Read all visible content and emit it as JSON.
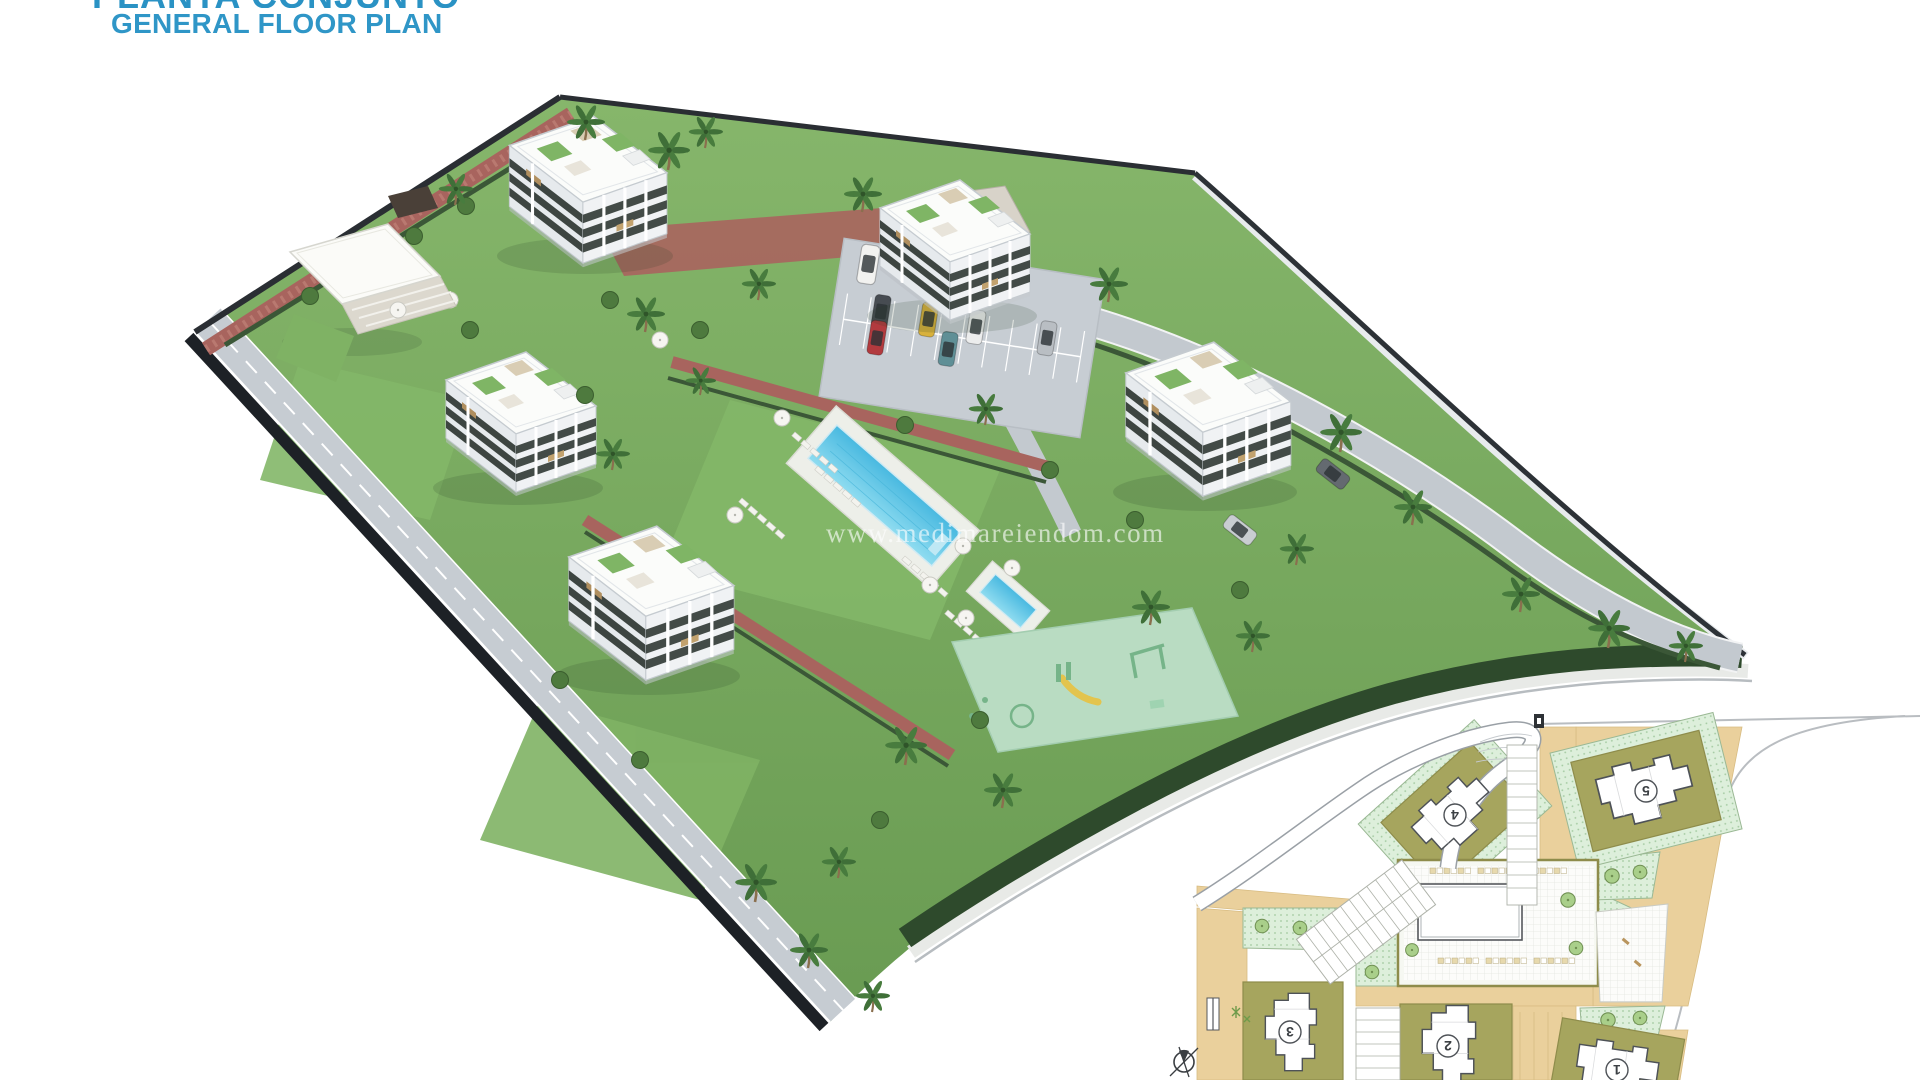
{
  "header": {
    "title": "PLANTA CONJUNTO",
    "subtitle": "GENERAL FLOOR PLAN"
  },
  "watermark": {
    "url_text": "www.medimareiendom.com"
  },
  "inset_plan": {
    "building_numbers": [
      "1",
      "2",
      "3",
      "4",
      "5"
    ],
    "icons": {
      "north_arrow": "circle-with-cross"
    }
  },
  "colors": {
    "accent_blue": "#2f96c7",
    "pool_blue": "#58c4e6",
    "grass_green": "#74a85e",
    "playground_mint": "#b9dcc2",
    "brick_path": "#a8645e",
    "road_gray": "#c6ccd2",
    "site_edge_dark": "#23282e",
    "inset_road_tan": "#ead09c",
    "inset_zone_olive": "#a6a55e",
    "inset_garden_green": "#ddefdb",
    "building_white": "#ffffff"
  }
}
